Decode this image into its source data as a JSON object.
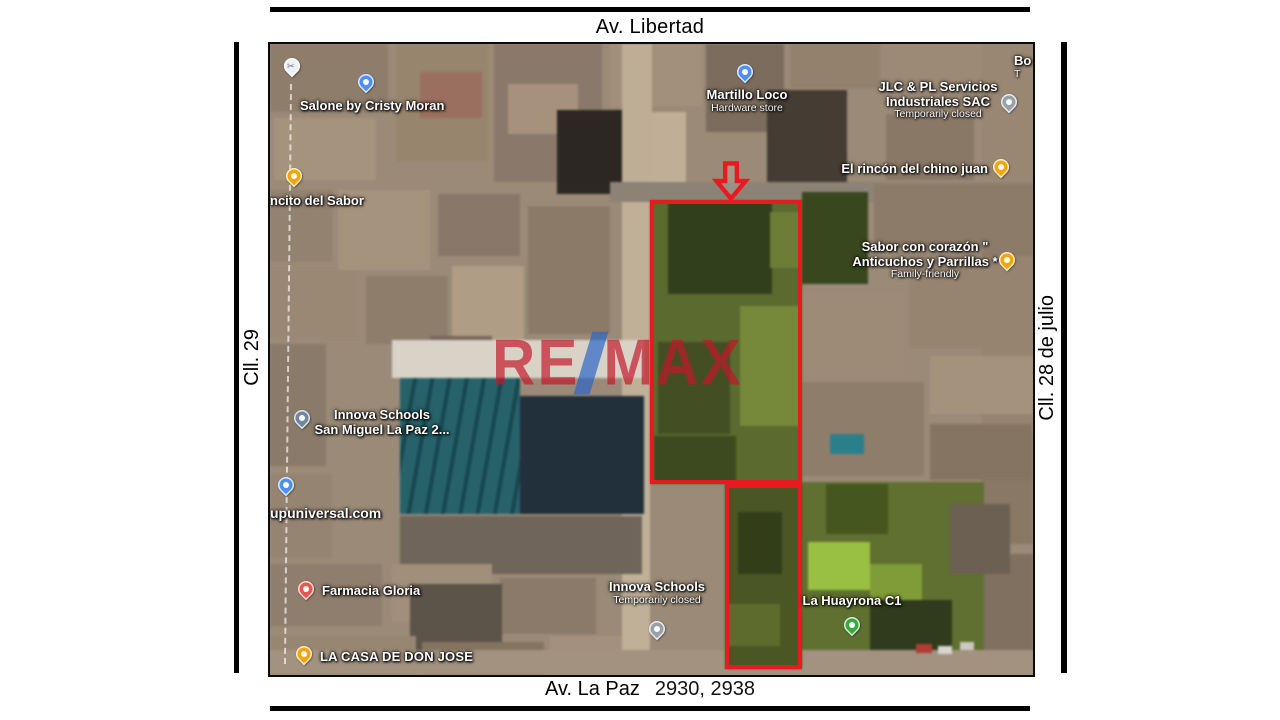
{
  "frame": {
    "top_road": "Av. Libertad",
    "bottom_road": "Av. La Paz",
    "bottom_addresses": "2930, 2938",
    "left_road": "Cll. 29",
    "right_road": "Cll. 28 de julio"
  },
  "map": {
    "watermark": {
      "part1": "RE",
      "part2": "MAX"
    },
    "pois": [
      {
        "name": "Salone by Cristy Moran"
      },
      {
        "name": "Martillo Loco",
        "sub": "Hardware store"
      },
      {
        "line1": "JLC & PL Servicios",
        "line2": "Industriales SAC",
        "sub": "Temporarily closed"
      },
      {
        "line1": "Bo",
        "line2": "T"
      },
      {
        "name": "El rincón del chino juan"
      },
      {
        "line1": "Sabor con corazón \"",
        "line2": "Anticuchos y Parrillas *",
        "sub": "Family-friendly"
      },
      {
        "name": "ncito del Sabor"
      },
      {
        "line1": "Innova Schools",
        "line2": "San Miguel La Paz 2..."
      },
      {
        "name": "upuniversal.com"
      },
      {
        "name": "Farmacia Gloria"
      },
      {
        "name": "LA CASA DE DON JOSE"
      },
      {
        "line1": "Innova Schools",
        "sub": "Temporarily closed"
      },
      {
        "name": "La Huayrona C1"
      }
    ]
  },
  "colors": {
    "parcel_outline": "#e81a20",
    "watermark_red": "#c41628",
    "watermark_blue": "#2864c8",
    "pin_orange": "#f5a50b",
    "pin_blue": "#4d8ef7",
    "pin_grey": "#98a0a8",
    "pin_red": "#e8564d",
    "pin_green": "#37a93c",
    "pin_steel": "#6f87a0",
    "pin_light": "#eef1f3"
  }
}
